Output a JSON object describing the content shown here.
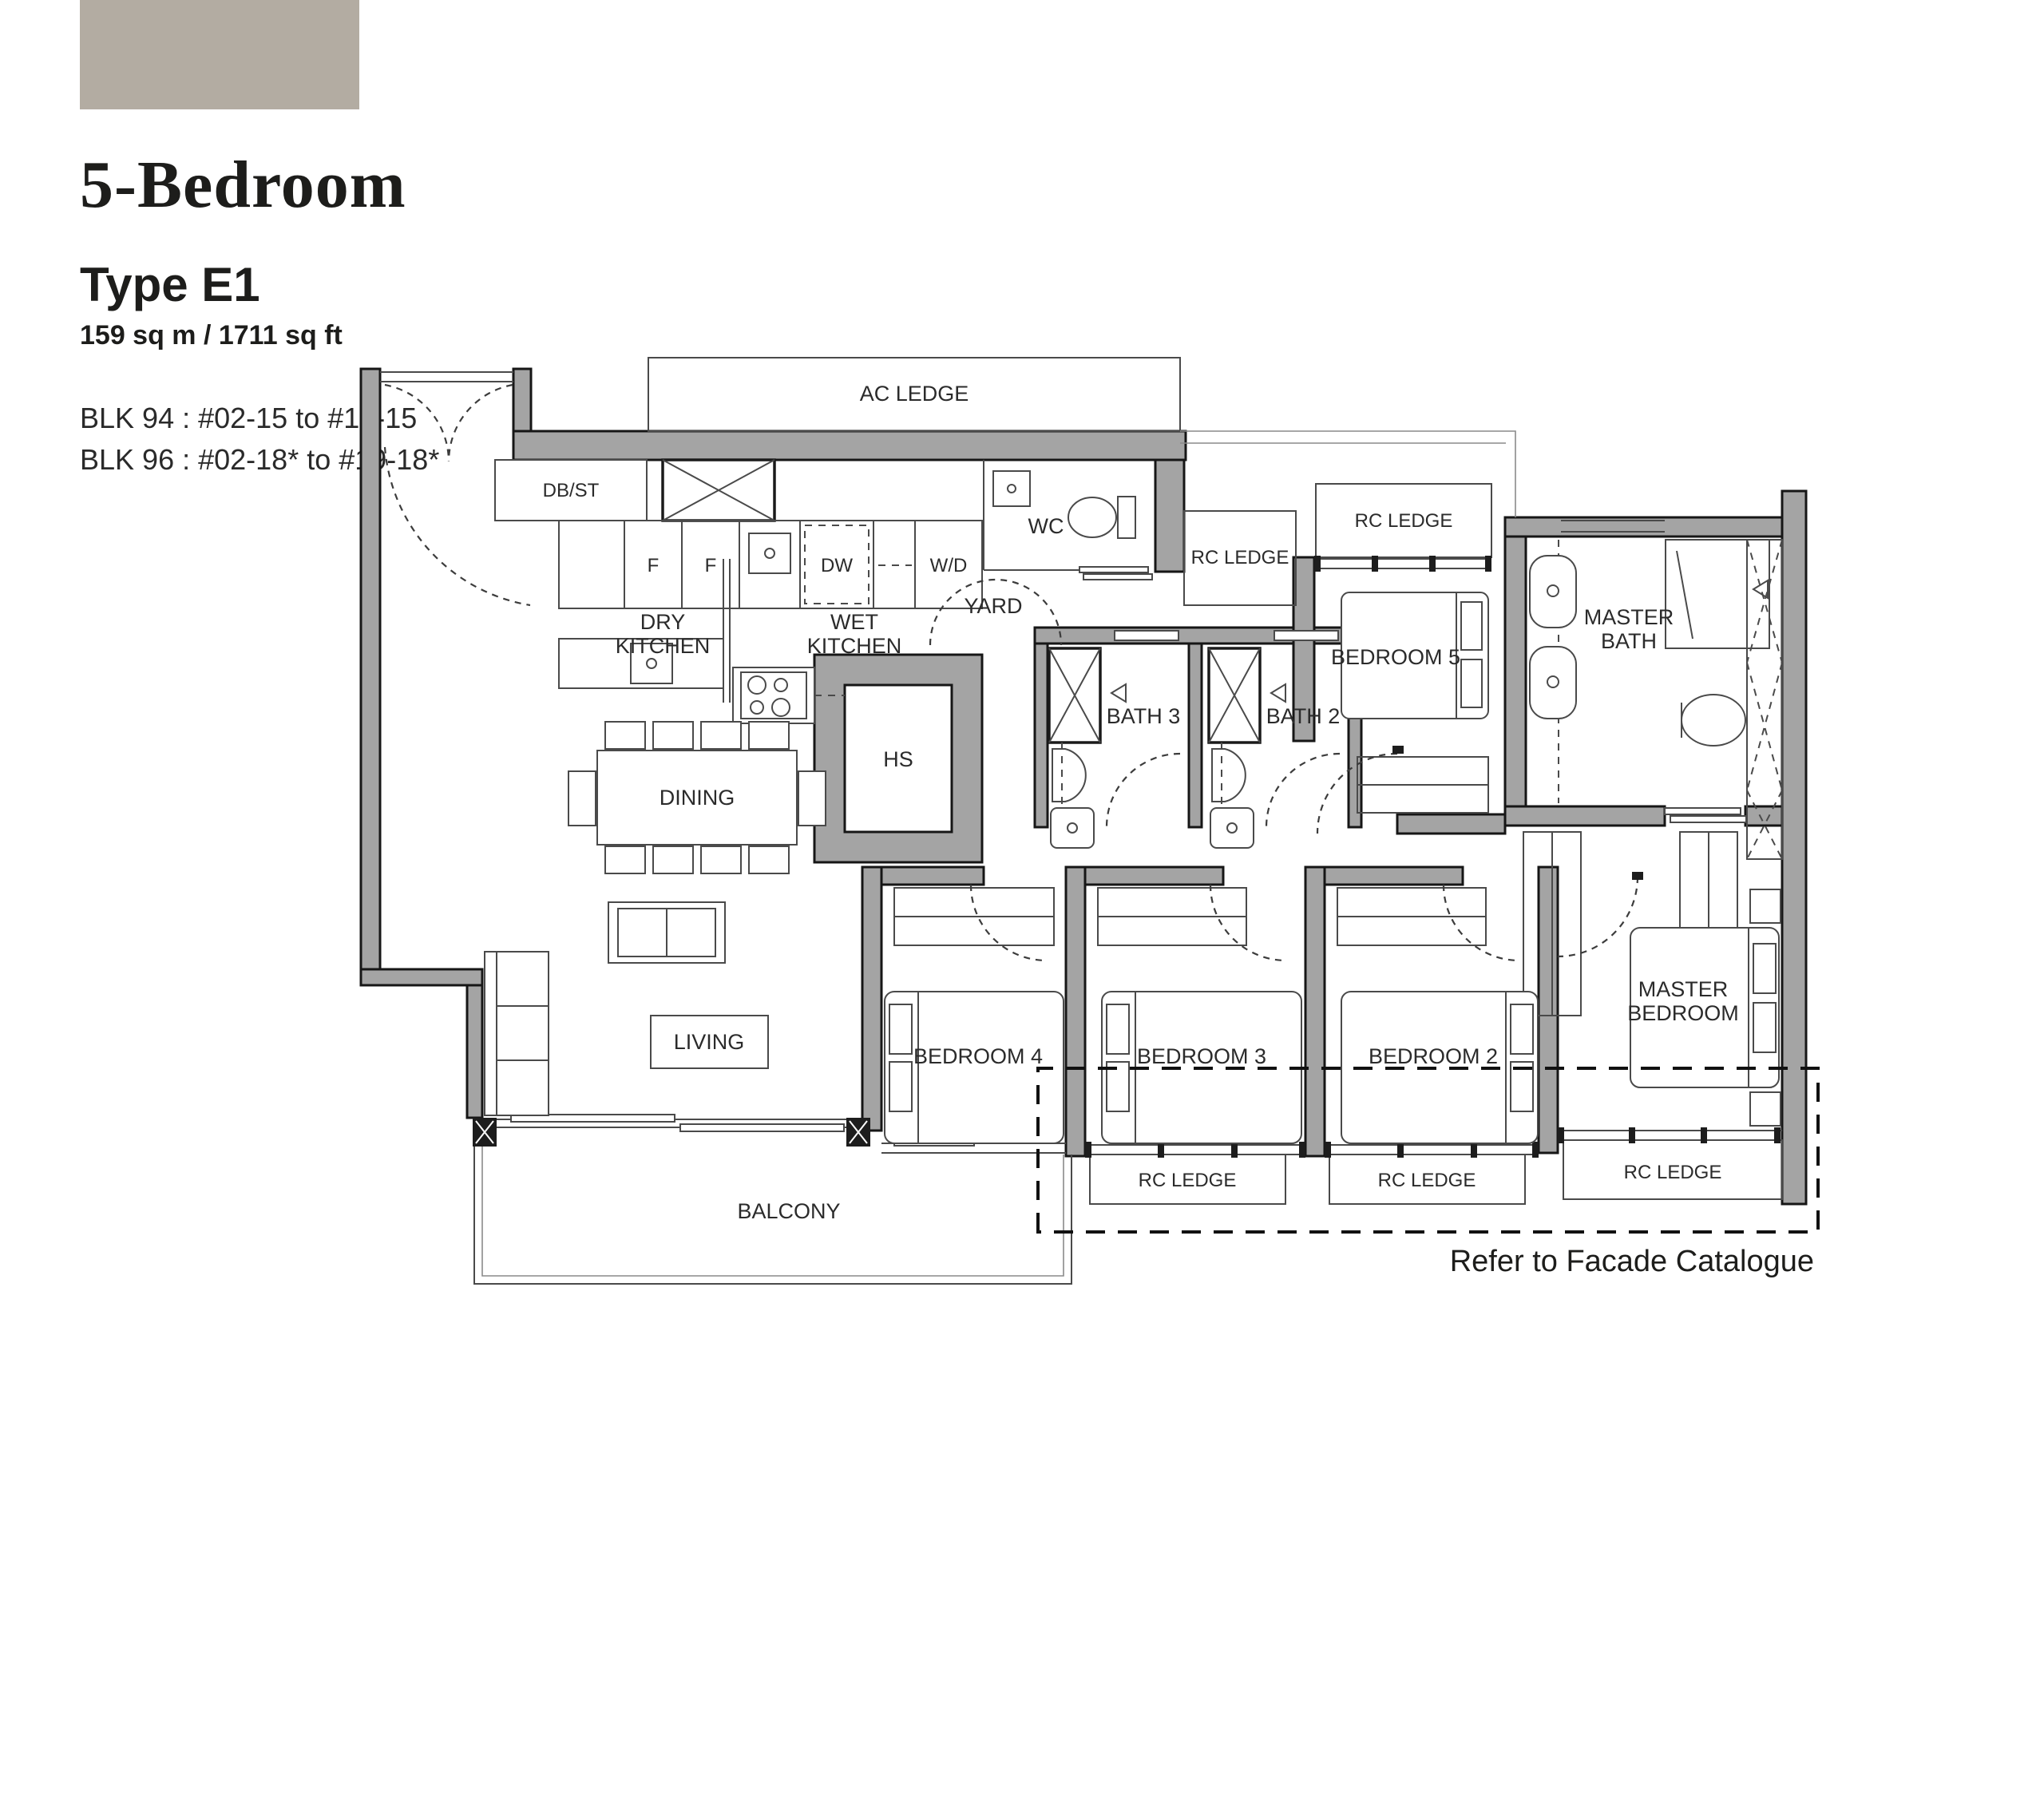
{
  "header": {
    "swatch_color": "#b3aca2",
    "title": "5-Bedroom",
    "type_label": "Type E1",
    "area": "159 sq m / 1711 sq ft",
    "block_1": "BLK 94 : #02-15 to #19-15",
    "block_2": "BLK 96 : #02-18* to #19-18*"
  },
  "plan": {
    "labels": [
      {
        "id": "ac-ledge",
        "text": "AC LEDGE"
      },
      {
        "id": "db-st",
        "text": "DB/ST"
      },
      {
        "id": "fridge-1",
        "text": "F"
      },
      {
        "id": "fridge-2",
        "text": "F"
      },
      {
        "id": "dishwasher",
        "text": "DW"
      },
      {
        "id": "washer-dryer",
        "text": "W/D"
      },
      {
        "id": "wc",
        "text": "WC"
      },
      {
        "id": "dry-kitchen-1",
        "text": "DRY"
      },
      {
        "id": "dry-kitchen-2",
        "text": "KITCHEN"
      },
      {
        "id": "wet-kitchen-1",
        "text": "WET"
      },
      {
        "id": "wet-kitchen-2",
        "text": "KITCHEN"
      },
      {
        "id": "yard",
        "text": "YARD"
      },
      {
        "id": "rc-ledge-wc",
        "text": "RC LEDGE"
      },
      {
        "id": "rc-ledge-bed5",
        "text": "RC LEDGE"
      },
      {
        "id": "bedroom-5",
        "text": "BEDROOM 5"
      },
      {
        "id": "master-bath-1",
        "text": "MASTER"
      },
      {
        "id": "master-bath-2",
        "text": "BATH"
      },
      {
        "id": "household-shelter",
        "text": "HS"
      },
      {
        "id": "bath-3",
        "text": "BATH 3"
      },
      {
        "id": "bath-2",
        "text": "BATH 2"
      },
      {
        "id": "dining",
        "text": "DINING"
      },
      {
        "id": "living",
        "text": "LIVING"
      },
      {
        "id": "bedroom-4",
        "text": "BEDROOM 4"
      },
      {
        "id": "bedroom-3",
        "text": "BEDROOM 3"
      },
      {
        "id": "bedroom-2",
        "text": "BEDROOM 2"
      },
      {
        "id": "master-bedroom-1",
        "text": "MASTER"
      },
      {
        "id": "master-bedroom-2",
        "text": "BEDROOM"
      },
      {
        "id": "balcony",
        "text": "BALCONY"
      },
      {
        "id": "rc-ledge-bed3",
        "text": "RC LEDGE"
      },
      {
        "id": "rc-ledge-bed2",
        "text": "RC LEDGE"
      },
      {
        "id": "rc-ledge-master",
        "text": "RC LEDGE"
      },
      {
        "id": "facade-note",
        "text": "Refer to Facade Catalogue"
      }
    ]
  }
}
